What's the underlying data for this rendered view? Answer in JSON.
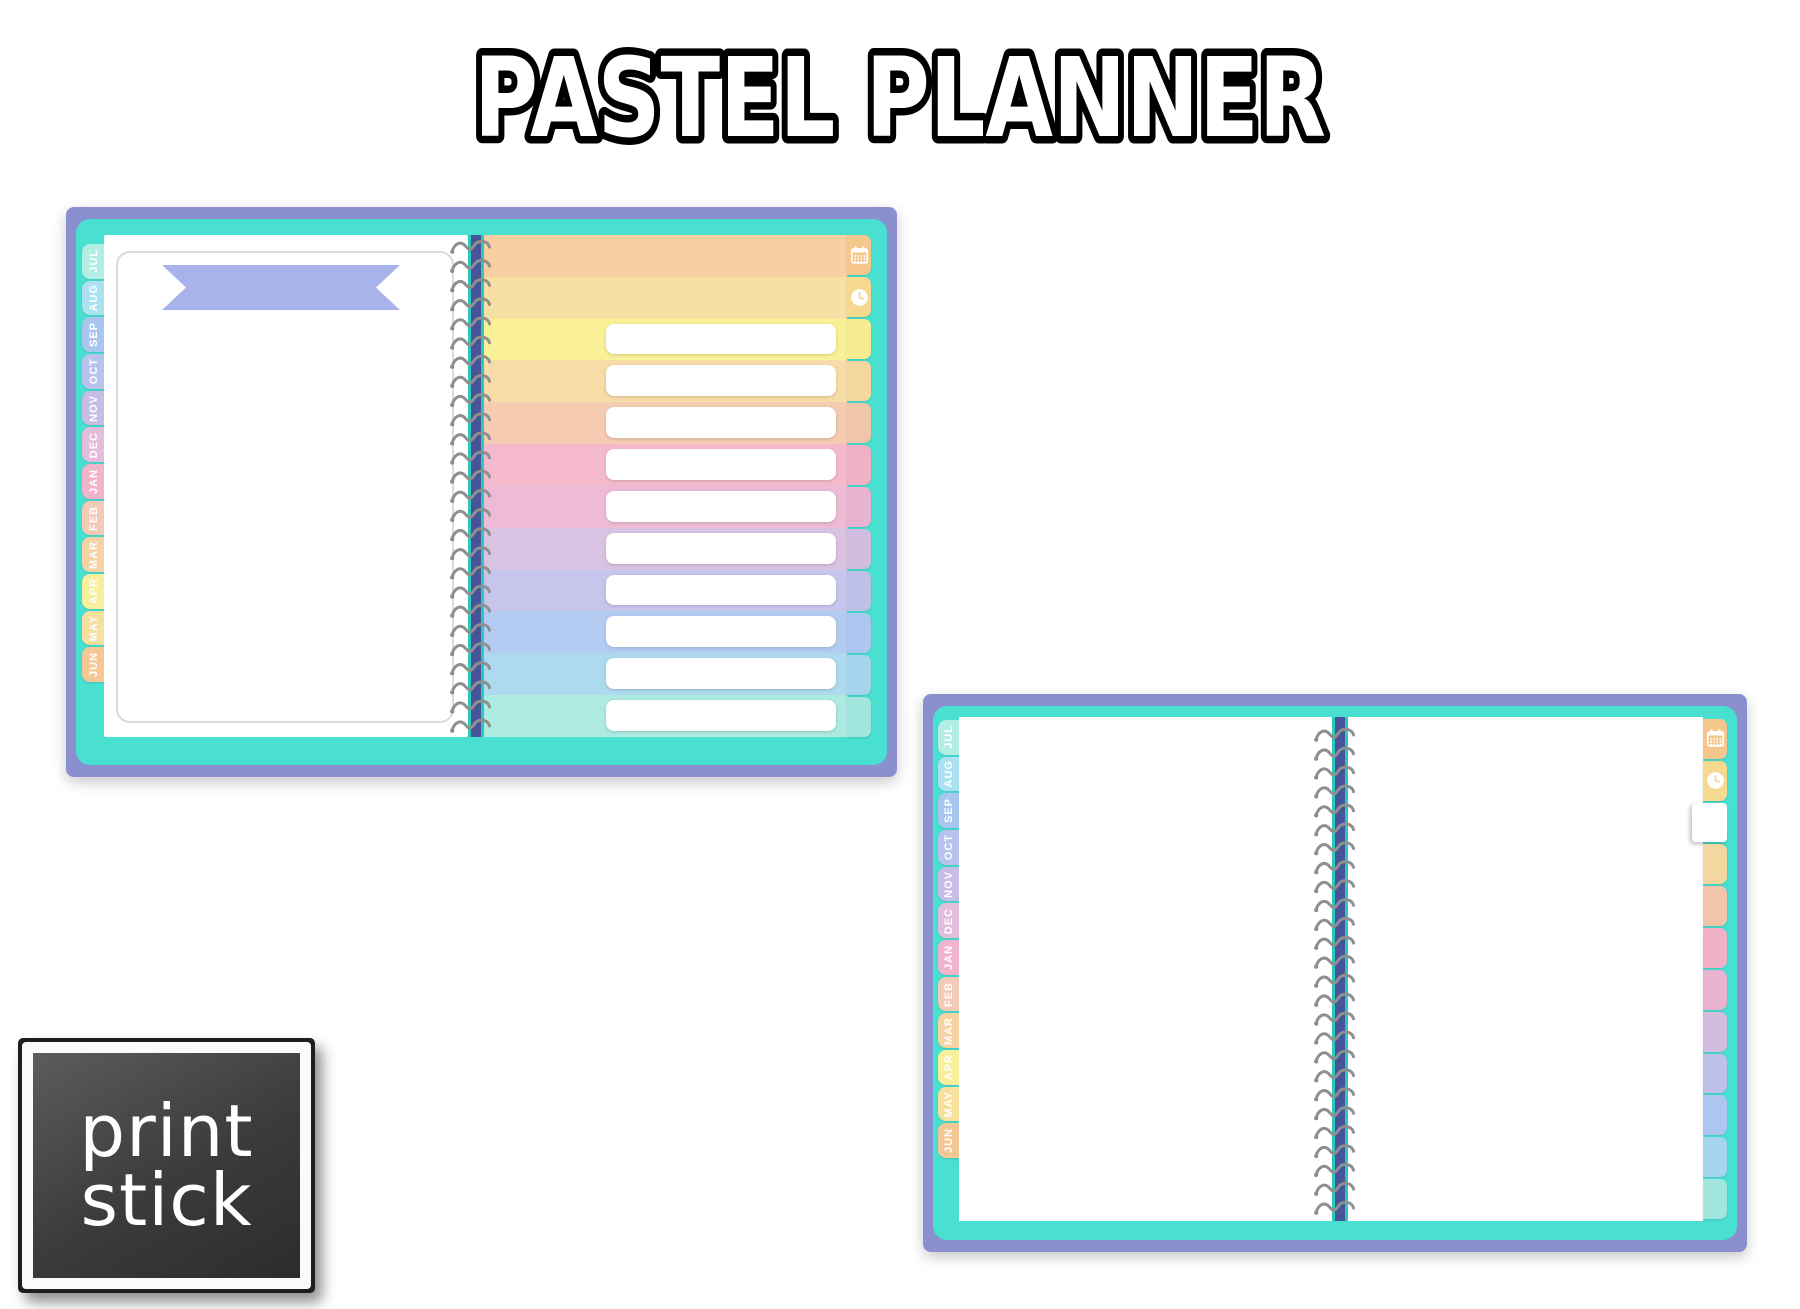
{
  "title": {
    "text": "PASTEL PLANNER"
  },
  "logo": {
    "line1": "print",
    "line2": "stick"
  },
  "months": [
    "JUL",
    "AUG",
    "SEP",
    "OCT",
    "NOV",
    "DEC",
    "JAN",
    "FEB",
    "MAR",
    "APR",
    "MAY",
    "JUN"
  ],
  "colors": {
    "background": "#FFFFFF",
    "border_purple": "#8A8FCE",
    "cover_teal": "#49E0D2",
    "spine_navy": "#47549A",
    "spine_edge_teal": "#2EC8BB",
    "banner_periwinkle": "#A8B3EB",
    "page_white": "#FFFFFF",
    "wire_gray": "#8F8F8F",
    "title_fill": "#FFFFFF",
    "title_outline": "#000000",
    "logo_bg": "#3A3A3A",
    "logo_text": "#FFFFFF",
    "month_tab_colors": [
      "#B2EEE3",
      "#ACE1F1",
      "#A9C6F1",
      "#B7C3EE",
      "#C8BDE7",
      "#E2BEDC",
      "#F2B3CC",
      "#F3C9B7",
      "#F6D3A2",
      "#F8EF9D",
      "#F7DF9E",
      "#F5C794"
    ]
  },
  "planner1": {
    "description": "open planner - title banner page and rainbow list page",
    "right_stripe_colors": [
      "#F7CFA0",
      "#F8E0A4",
      "#F9F098",
      "#F7DCA8",
      "#F5CBB2",
      "#F4B9CD",
      "#EDBBD5",
      "#DAC2E3",
      "#C6C6EC",
      "#B5CCF2",
      "#AEDAF0",
      "#ACEAE2"
    ],
    "right_tab_colors": [
      "#F5C78C",
      "#F5D98F",
      "#F7EC8F",
      "#F3D79E",
      "#F1C5AA",
      "#F0B0C5",
      "#E7B3D0",
      "#D2BCE0",
      "#BFC0E9",
      "#ADC6F0",
      "#A6D4EE",
      "#A3E6DE"
    ],
    "side_tab_icons": [
      "calendar-icon",
      "clock-icon"
    ],
    "active_tab_index": -1,
    "list_rows": 10,
    "spiral_loops": 26
  },
  "planner2": {
    "description": "open planner - blank spread with white active tab",
    "right_stripe_colors": null,
    "right_tab_colors": [
      "#F5C78C",
      "#F5D98F",
      "#FFFFFF",
      "#F3D79E",
      "#F1C5AA",
      "#F0B0C5",
      "#E7B3D0",
      "#D2BCE0",
      "#BFC0E9",
      "#ADC6F0",
      "#A6D4EE",
      "#A3E6DE"
    ],
    "side_tab_icons": [
      "calendar-icon",
      "clock-icon"
    ],
    "active_tab_index": 2,
    "list_rows": 0,
    "spiral_loops": 26
  }
}
